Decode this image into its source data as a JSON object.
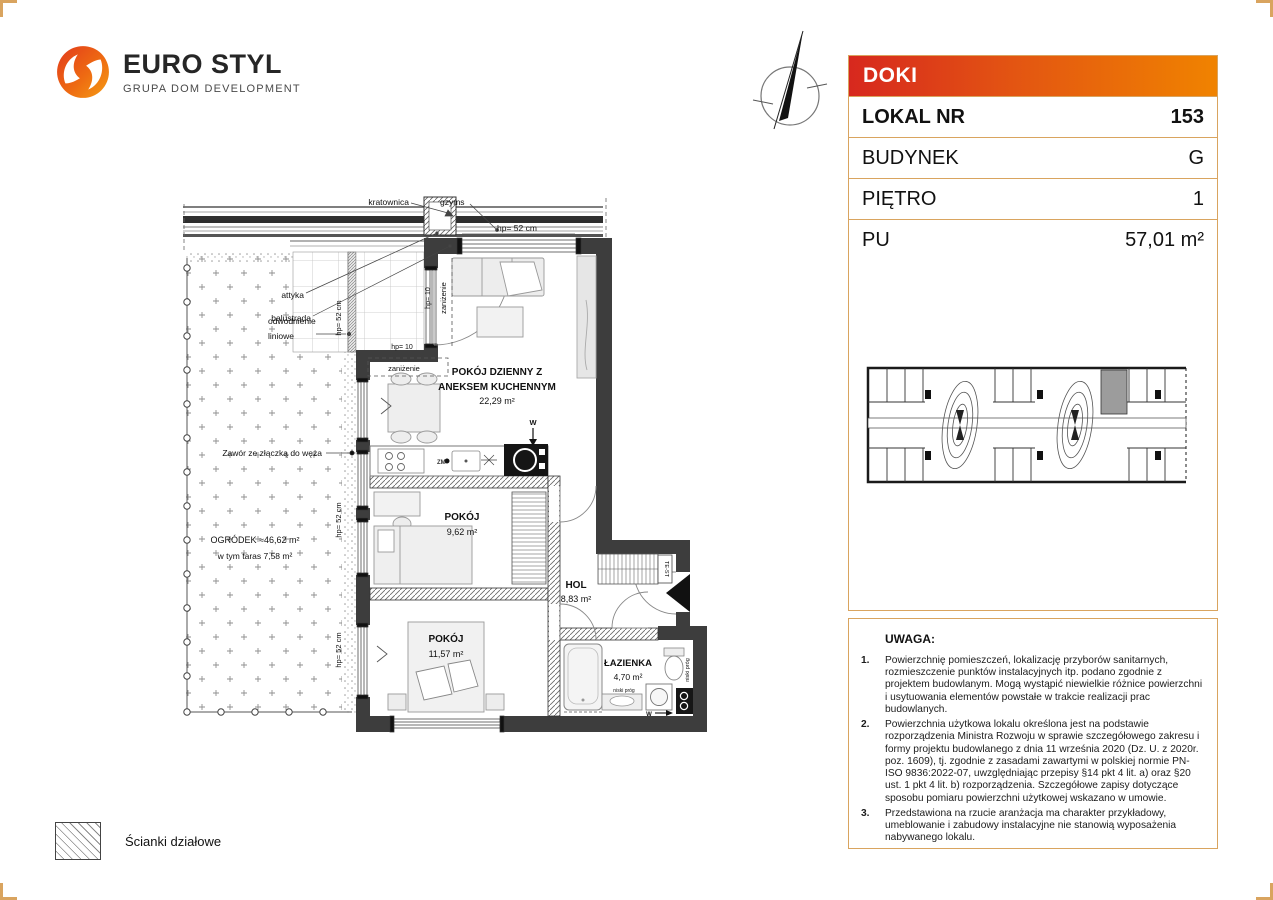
{
  "brand": {
    "name": "EURO STYL",
    "tagline": "GRUPA DOM DEVELOPMENT"
  },
  "unit_card": {
    "project": "DOKI",
    "rows": [
      {
        "label": "LOKAL NR",
        "value": "153"
      },
      {
        "label": "BUDYNEK",
        "value": "G"
      },
      {
        "label": "PIĘTRO",
        "value": "1"
      },
      {
        "label": "PU",
        "value": "57,01 m²"
      }
    ]
  },
  "notes": {
    "title": "UWAGA:",
    "items": [
      {
        "num": "1.",
        "text": "Powierzchnię pomieszczeń, lokalizację przyborów sanitarnych, rozmieszczenie punktów instalacyjnych itp. podano zgodnie z projektem budowlanym. Mogą wystąpić niewielkie różnice powierzchni i usytuowania elementów powstałe w trakcie realizacji prac budowlanych."
      },
      {
        "num": "2.",
        "text": "Powierzchnia użytkowa lokalu określona jest na podstawie rozporządzenia Ministra Rozwoju w sprawie szczegółowego zakresu i formy projektu budowlanego z dnia 11 września 2020 (Dz. U. z 2020r. poz. 1609), tj. zgodnie z zasadami zawartymi w polskiej normie PN-ISO 9836:2022-07, uwzględniając przepisy §14 pkt 4 lit. a) oraz §20 ust. 1 pkt 4 lit. b) rozporządzenia. Szczegółowe zapisy dotyczące sposobu pomiaru powierzchni użytkowej wskazano w umowie."
      },
      {
        "num": "3.",
        "text": "Przedstawiona na rzucie aranżacja ma charakter przykładowy, umeblowanie i zabudowy instalacyjne nie stanowią wyposażenia nabywanego lokalu."
      }
    ]
  },
  "legend": {
    "partition_walls": "Ścianki działowe"
  },
  "plan": {
    "rooms": {
      "living_l1": "POKÓJ DZIENNY Z",
      "living_l2": "ANEKSEM KUCHENNYM",
      "living_area": "22,29 m²",
      "room1": "POKÓJ",
      "room1_area": "9,62 m²",
      "room2": "POKÓJ",
      "room2_area": "11,57 m²",
      "hol": "HOL",
      "hol_area": "8,83 m²",
      "bath": "ŁAZIENKA",
      "bath_area": "4,70 m²"
    },
    "garden": {
      "line1": "OGRÓDEK  ≈46,62 m²",
      "line2": "w tym taras 7,58 m²"
    },
    "labels": {
      "kratownica": "kratownica",
      "gzyms": "gzyms",
      "attyka": "attyka",
      "balustrada": "balustrada",
      "odwodnienie_l1": "odwodnienie",
      "odwodnienie_l2": "liniowe",
      "zawor": "Zawór ze złączką do węża",
      "hp52": "hp= 52 cm",
      "hp10": "hp= 10",
      "zanizenie": "zaniżenie",
      "niski_prog": "niski próg",
      "test": "TE-ST",
      "w": "W",
      "zm": "ZM"
    }
  },
  "colors": {
    "accent_red": "#d7281e",
    "accent_orange": "#f08300",
    "panel_border": "#d9a45f",
    "wall_dark": "#3d3d3d"
  }
}
